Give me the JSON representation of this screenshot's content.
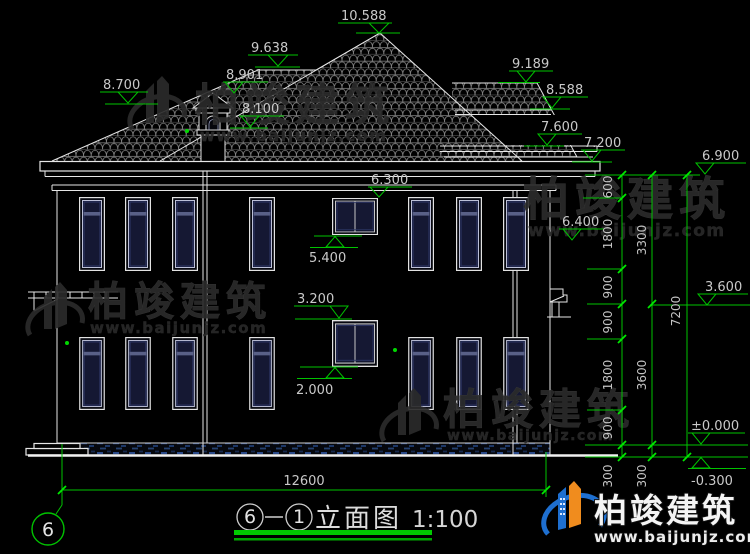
{
  "drawing": {
    "title": {
      "axis_from": "6",
      "axis_to": "1",
      "name": "立面图",
      "scale": "1:100"
    },
    "axis_bubble_label": "6",
    "levels": {
      "peak": "10.588",
      "left_ridge": "9.638",
      "left_slope": "8.700",
      "chimney_top": "8.901",
      "chimney_base": "8.100",
      "right_ridge": "9.189",
      "right_eave_top": "8.588",
      "right_fascia": "7.600",
      "main_eave_top": "7.200",
      "ceiling": "6.900",
      "eave_bottom": "6.300",
      "right_wing_eave": "6.400",
      "win2f_sill": "5.400",
      "awning_right": "3.600",
      "win1f_top": "3.200",
      "win1f_sill": "2.000",
      "ground": "±0.000",
      "grade": "-0.300"
    },
    "dims": {
      "overall_width": "12600",
      "chain_inner": [
        "600",
        "1800",
        "900",
        "900",
        "1800",
        "900",
        "300"
      ],
      "chain_middle": [
        "3300",
        "3600",
        "300"
      ],
      "chain_outer": [
        "7200"
      ]
    }
  },
  "watermark": {
    "brand": "柏竣建筑",
    "url": "www.baijunjz.com"
  },
  "logo": {
    "brand": "柏竣建筑",
    "url": "www.baijunjz.com"
  },
  "colors": {
    "background": "#000000",
    "line_white": "#e6e6e6",
    "dim_green": "#00c300",
    "glass_navy": "#151833",
    "transom": "#596087",
    "plinth_blue": "#2a4a8a",
    "logo_blue": "#1e6fd0",
    "logo_orange": "#f08c1e"
  }
}
